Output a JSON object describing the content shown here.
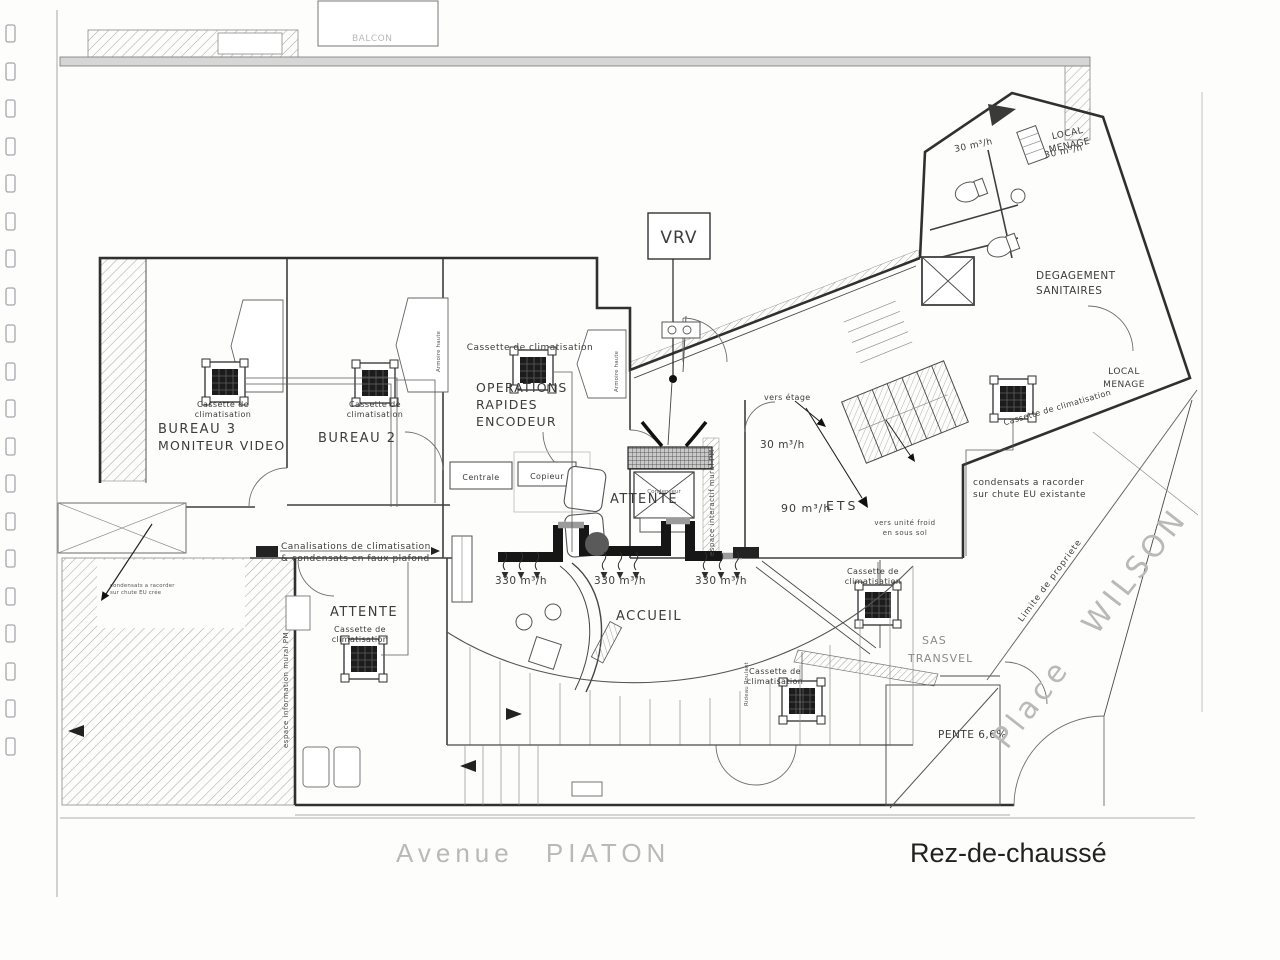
{
  "page": {
    "title": "Rez-de-chaussé",
    "street_bottom": "Avenue PIATON",
    "square_right": "Place WILSON",
    "property_line": "Limite de propriete",
    "balcony": "BALCON"
  },
  "rooms": {
    "bureau3_l1": "BUREAU 3",
    "bureau3_l2": "MONITEUR VIDEO",
    "bureau2": "BUREAU 2",
    "operations_l1": "OPERATIONS",
    "operations_l2": "RAPIDES",
    "operations_l3": "ENCODEUR",
    "attente_center": "ATTENTE",
    "attente_left": "ATTENTE",
    "accueil": "ACCUEIL",
    "degagement_l1": "DEGAGEMENT",
    "degagement_l2": "SANITAIRES",
    "local_menage_l1": "LOCAL",
    "local_menage_l2": "MENAGE",
    "ets": "ETS",
    "sas_l1": "SAS",
    "sas_l2": "TRANSVEL",
    "pente": "PENTE 6,6%"
  },
  "equipment": {
    "vrv": "VRV",
    "cassette_l1": "Cassette de",
    "cassette_l2": "climatisation",
    "cassette_single": "Cassette de climatisation",
    "centrale": "Centrale",
    "copieur": "Copieur",
    "condenseur": "Condenseur",
    "armoire": "Armoire haute"
  },
  "airflows": {
    "f330": "330 m³/h",
    "f30": "30 m³/h",
    "f90": "90 m³/h"
  },
  "notes": {
    "canalisations_l1": "Canalisations de climatisation",
    "canalisations_l2": "& condensats en faux plafond",
    "condensats_l1": "condensats a racorder",
    "condensats_l2": "sur chute EU existante",
    "condensats_small_l1": "condensats a racorder",
    "condensats_small_l2": "sur chute EU crée",
    "vers_etage": "vers étage",
    "vers_unite_l1": "vers unité froid",
    "vers_unite_l2": "en sous sol",
    "espace_info": "espace information mural PM",
    "espace_interactif": "espace interactif mural PM",
    "rideau": "Rideau Roulant"
  }
}
